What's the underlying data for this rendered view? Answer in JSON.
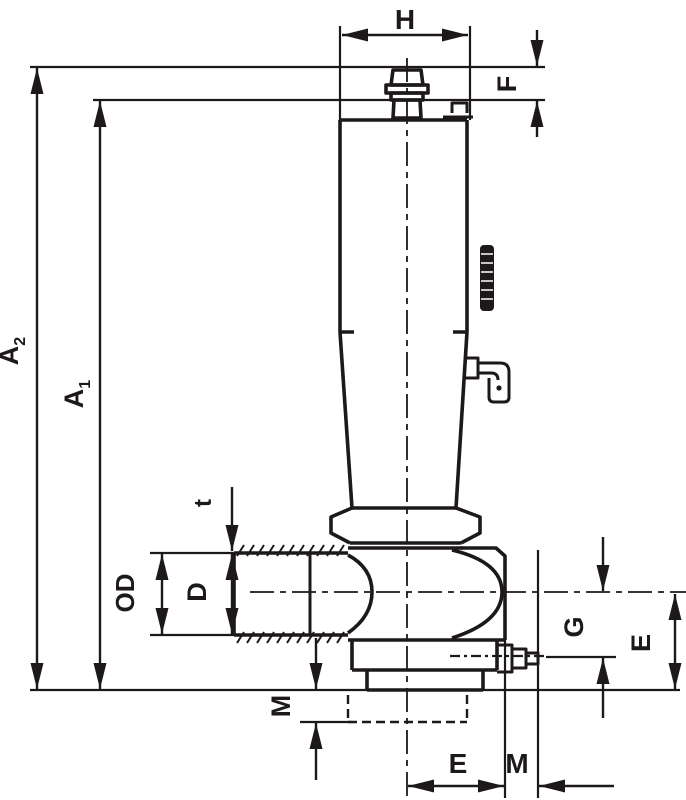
{
  "drawing": {
    "description": "Dimensioned technical line drawing of a valve with vertical handle",
    "line_color": "#1d191a",
    "background_color": "#ffffff",
    "labels": {
      "h": "H",
      "f": "F",
      "a2_base": "A",
      "a2_sub": "2",
      "a1_base": "A",
      "a1_sub": "1",
      "t": "t",
      "od": "OD",
      "d": "D",
      "m_left": "M",
      "g": "G",
      "e_right": "E",
      "e_bottom": "E",
      "m_bottom": "M"
    }
  }
}
